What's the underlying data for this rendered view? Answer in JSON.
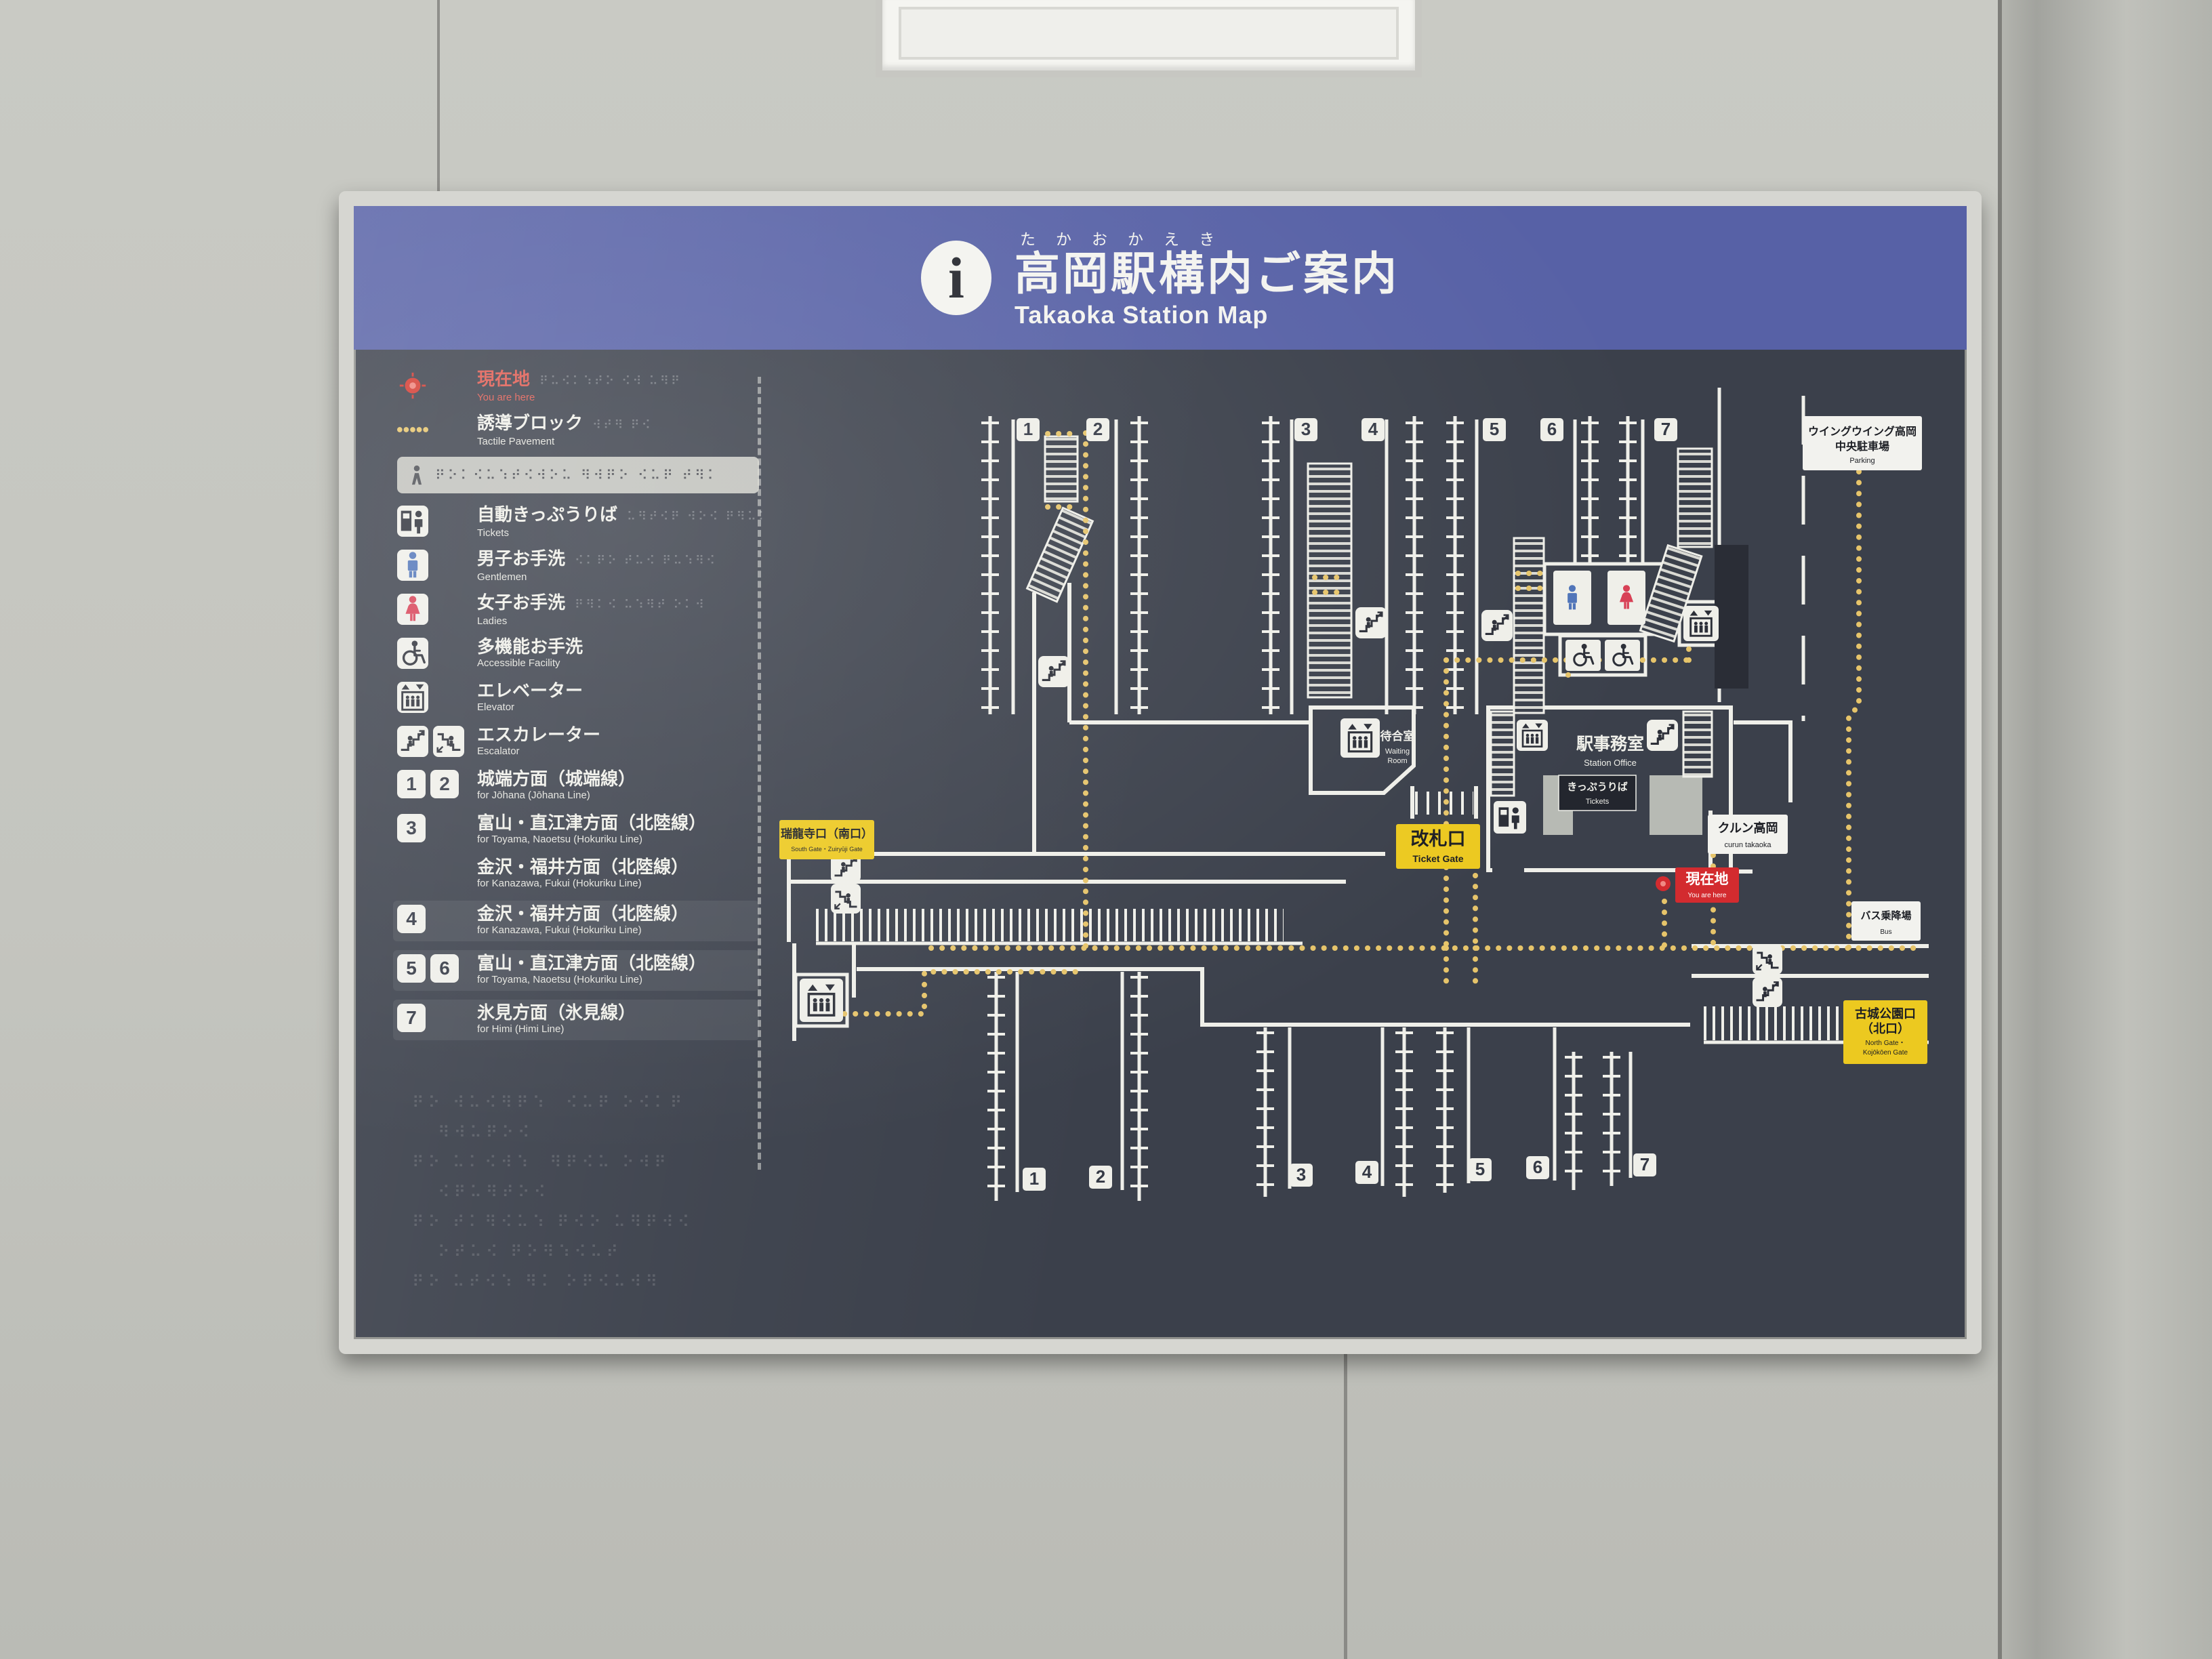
{
  "header": {
    "info_icon": "i",
    "furigana": "たかおかえき",
    "title": "高岡駅構内ご案内",
    "subtitle": "Takaoka Station Map"
  },
  "legend": {
    "items": [
      {
        "icon": "dot",
        "jp": "現在地",
        "en": "You are here",
        "accent": "red",
        "br": "⠟⠥⠪⠅⠱⠞⠕ ⠪⠺ ⠥⠻⠟"
      },
      {
        "icon": "tactile",
        "jp": "誘導ブロック",
        "en": "Tactile Pavement",
        "br": "⠺⠞⠻ ⠟⠪"
      },
      {
        "type": "braille",
        "braille": "⠟⠕⠅⠪⠥⠱⠞⠪⠺⠕⠥ ⠻⠺⠟⠕ ⠪⠥⠟ ⠞⠻⠅"
      },
      {
        "icon": "machine",
        "jp": "自動きっぷうりば",
        "en": "Tickets",
        "br": "⠥⠻⠞⠪⠟ ⠺⠕⠪ ⠟⠻⠥⠅"
      },
      {
        "icon": "man",
        "jp": "男子お手洗",
        "en": "Gentlemen",
        "br": "⠪⠅⠟⠕ ⠞⠥⠪ ⠟⠥⠱⠻⠪"
      },
      {
        "icon": "woman",
        "jp": "女子お手洗",
        "en": "Ladies",
        "br": "⠟⠻⠅⠪ ⠥⠱⠻⠞ ⠕⠅⠺"
      },
      {
        "icon": "wheelchair",
        "jp": "多機能お手洗",
        "en": "Accessible Facility"
      },
      {
        "icon": "elevator",
        "jp": "エレベーター",
        "en": "Elevator"
      },
      {
        "icon": "escalator",
        "double": true,
        "jp": "エスカレーター",
        "en": "Escalator"
      },
      {
        "numbers": [
          "1",
          "2"
        ],
        "jp": "城端方面（城端線）",
        "en": "for Jōhana (Jōhana Line)"
      },
      {
        "numbers": [
          "3"
        ],
        "jp": "富山・直江津方面（北陸線）",
        "en": "for Toyama, Naoetsu (Hokuriku Line)"
      },
      {
        "numbers": [],
        "jp": "金沢・福井方面（北陸線）",
        "en": "for Kanazawa, Fukui (Hokuriku Line)"
      },
      {
        "numbers": [
          "4"
        ],
        "jp": "金沢・福井方面（北陸線）",
        "en": "for Kanazawa, Fukui (Hokuriku Line)",
        "highlight": true
      },
      {
        "numbers": [
          "5",
          "6"
        ],
        "jp": "富山・直江津方面（北陸線）",
        "en": "for Toyama, Naoetsu (Hokuriku Line)",
        "highlight": true
      },
      {
        "numbers": [
          "7"
        ],
        "jp": "氷見方面（氷見線）",
        "en": "for Himi (Himi Line)",
        "highlight": true
      }
    ],
    "braille_paragraph": [
      "⠟⠕ ⠺⠥⠪⠻⠟⠱  ⠪⠥⠟ ⠕⠪⠅⠟",
      "   ⠻⠺⠥⠟⠕⠪",
      "⠟⠕ ⠥⠅⠪⠺⠱  ⠻⠟⠪⠥ ⠕⠺⠟",
      "   ⠪⠟⠥⠻⠞⠕⠪",
      "⠟⠕ ⠞⠅⠻⠪⠥⠱ ⠟⠪⠕ ⠥⠻⠟⠺⠪",
      "   ⠕⠞⠥⠪ ⠟⠕⠻⠱⠪⠥⠞",
      "⠟⠕ ⠥⠞⠪⠱ ⠻⠅ ⠕⠟⠪⠥⠺⠻"
    ]
  },
  "map": {
    "badges_top": [
      "1",
      "2",
      "3",
      "4",
      "5",
      "6",
      "7"
    ],
    "badges_bottom": [
      "1",
      "2",
      "3",
      "4",
      "5",
      "6",
      "7"
    ],
    "labels": {
      "parking": {
        "jp1": "ウイングウイング高岡",
        "jp2": "中央駐車場",
        "en": "Parking"
      },
      "south_gate": {
        "jp": "瑞龍寺口（南口）",
        "en": "South Gate・Zuiryūji Gate"
      },
      "north_gate": {
        "jp1": "古城公園口",
        "jp2": "（北口）",
        "en1": "North Gate・",
        "en2": "Kojōkōen Gate"
      },
      "ticket_gate": {
        "jp": "改札口",
        "en": "Ticket Gate"
      },
      "station_office": {
        "jp": "駅事務室",
        "en": "Station Office"
      },
      "tickets_office": {
        "jp": "きっぷうりば",
        "en": "Tickets"
      },
      "waiting_room": {
        "jp": "待合室",
        "en1": "Waiting",
        "en2": "Room"
      },
      "curun": {
        "jp": "クルン高岡",
        "en": "curun takaoka"
      },
      "bus": {
        "jp": "バス乗降場",
        "en": "Bus"
      },
      "you_are_here": {
        "jp": "現在地",
        "en": "You are here"
      }
    },
    "colors": {
      "board": "#3b404b",
      "header_blue": "#5761a6",
      "line_white": "#efefe9",
      "tactile_yellow": "#e6c46a",
      "label_yellow": "#ecc920",
      "alert_red": "#d32b2f",
      "men_blue": "#4f74b8",
      "women_red": "#d84055"
    }
  }
}
